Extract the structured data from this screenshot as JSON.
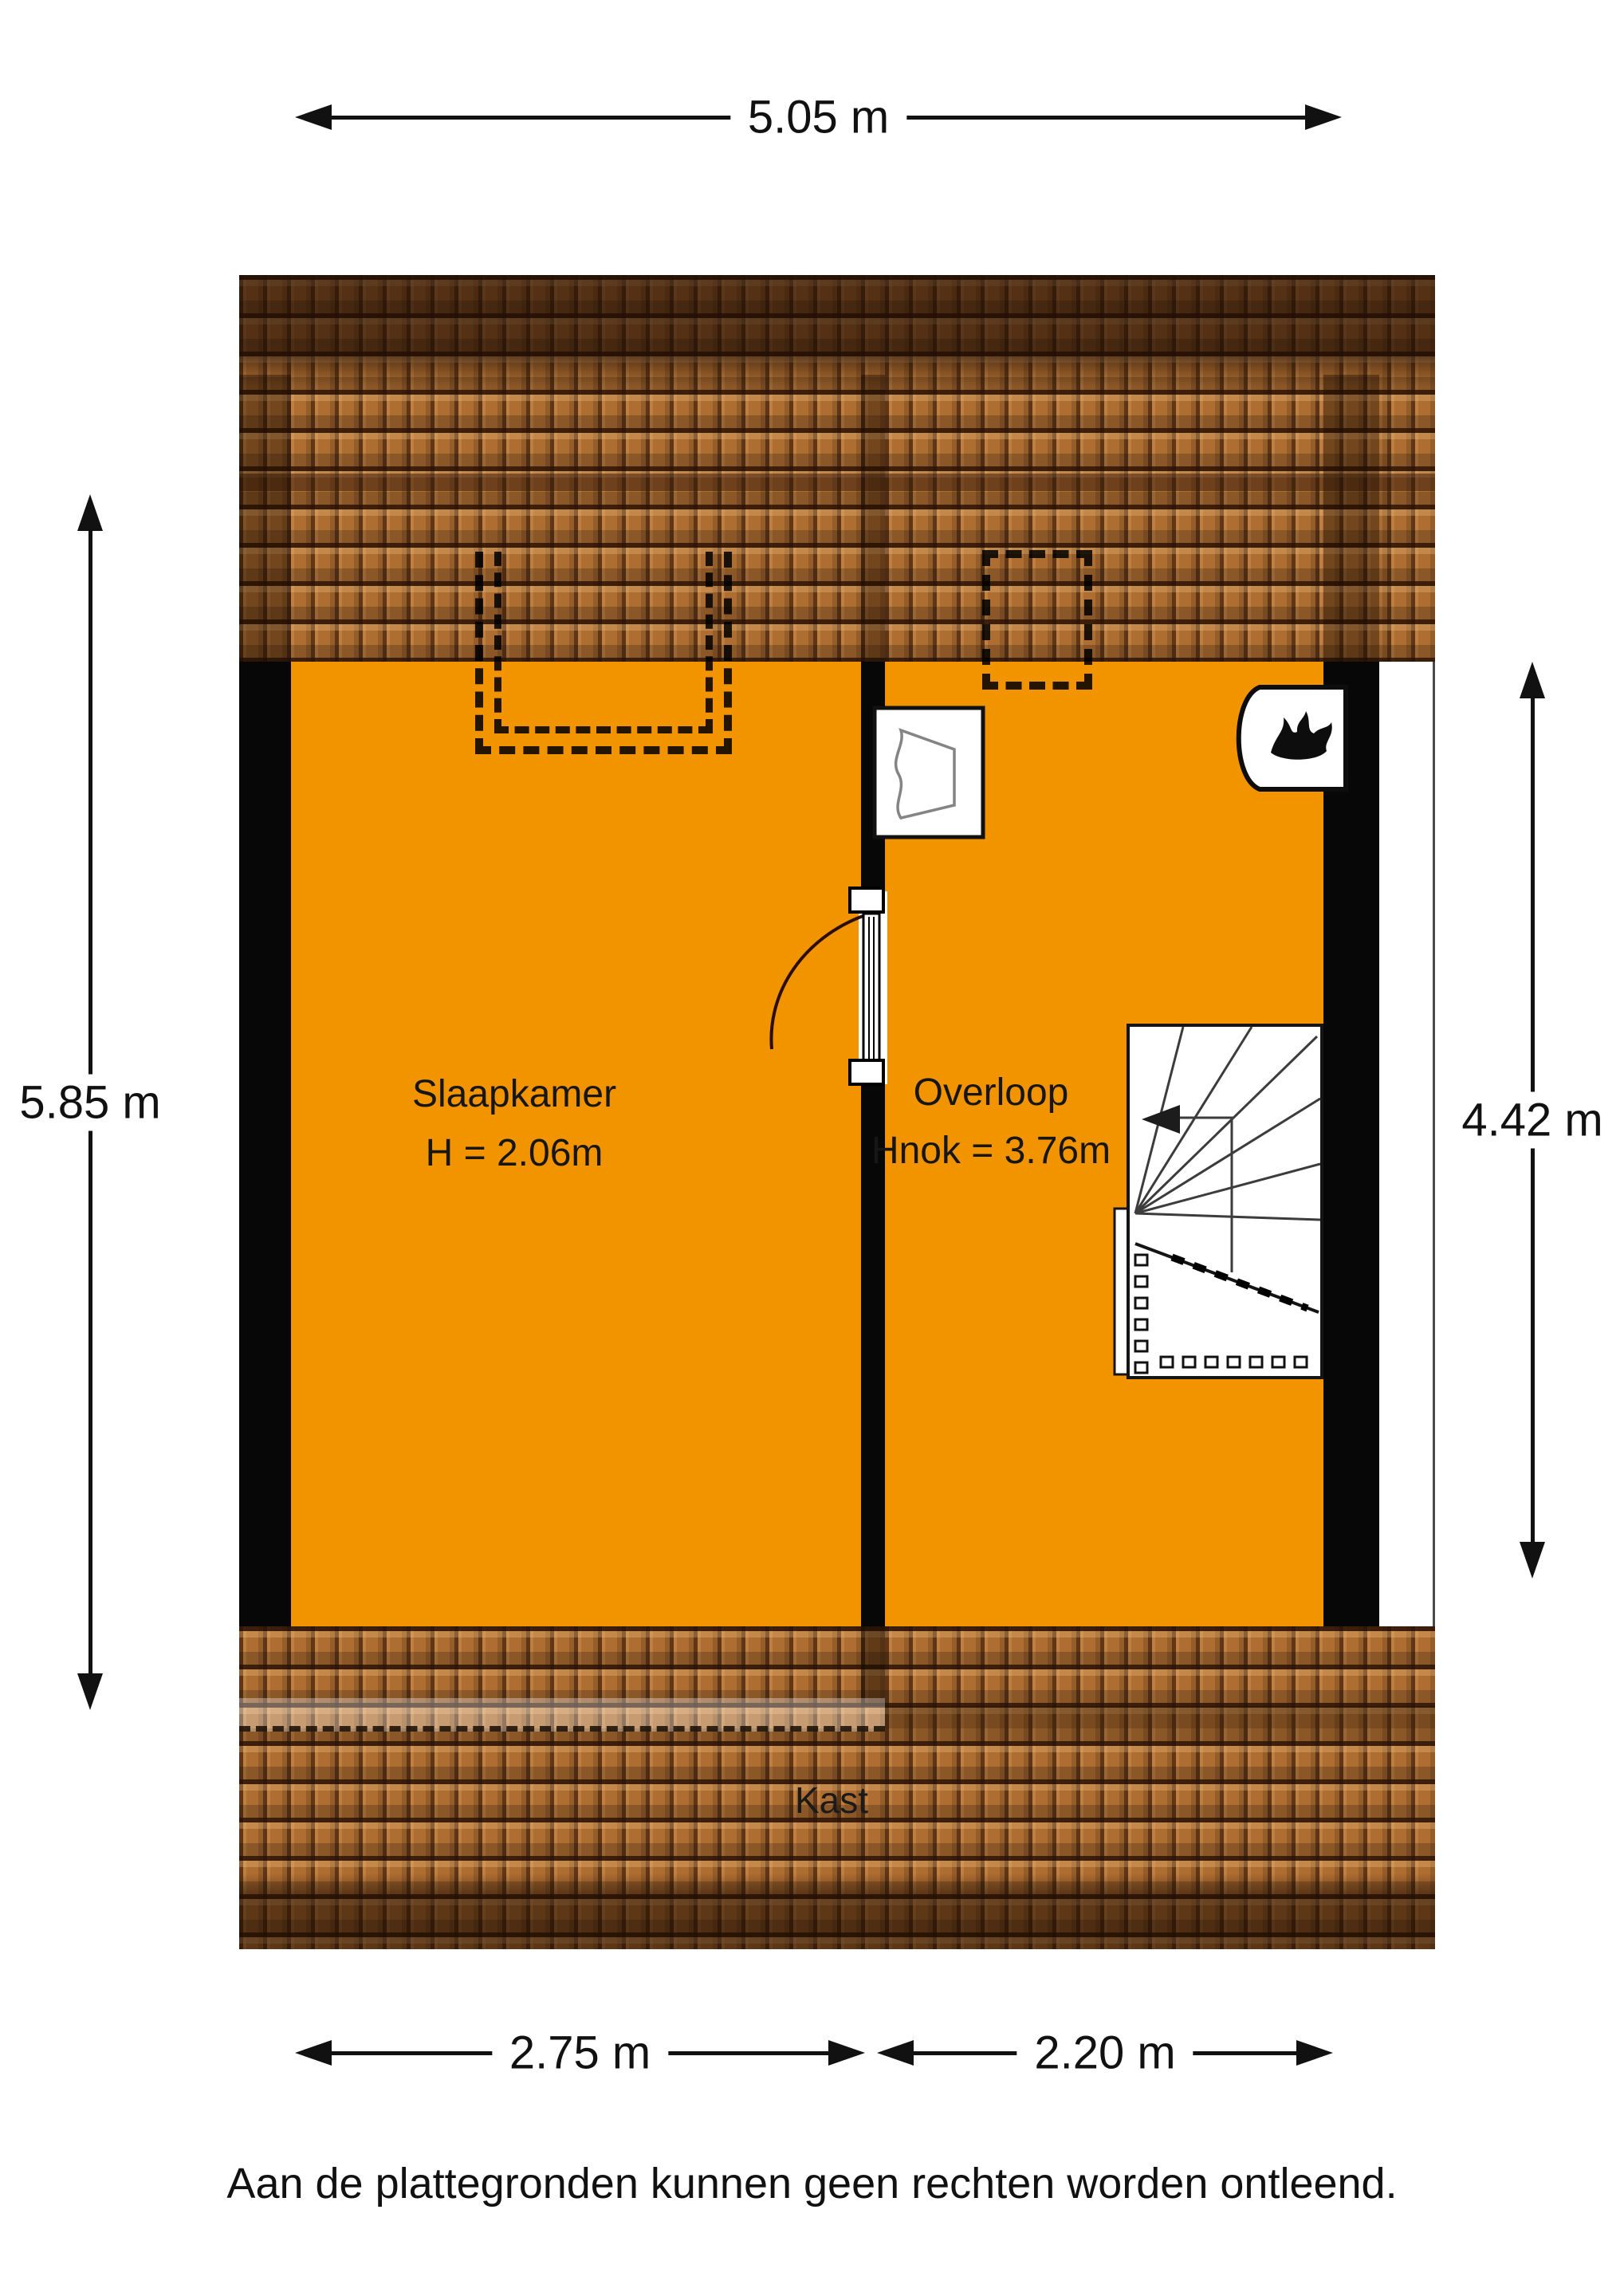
{
  "plan": {
    "dimensions": {
      "width_total": "5.05 m",
      "height_left": "5.85 m",
      "height_right": "4.42 m",
      "width_bottom_left": "2.75 m",
      "width_bottom_right": "2.20 m"
    },
    "rooms": {
      "slaapkamer": {
        "name": "Slaapkamer",
        "height": "H = 2.06m"
      },
      "overloop": {
        "name": "Overloop",
        "ridge_height": "Hnok = 3.76m"
      },
      "kast": {
        "name": "Kast"
      }
    },
    "icons": {
      "boiler": "flame-icon",
      "sink": "sink-icon",
      "stairs": "staircase-icon",
      "door": "door-swing-icon",
      "dormer_slaapkamer": "dormer-window-icon",
      "dormer_overloop": "dormer-window-icon"
    },
    "colors": {
      "floor": "#F29300",
      "roof_tile": "#AE6D31",
      "roof_dark": "#5F3A1E",
      "wall": "#070707"
    }
  },
  "footer": {
    "disclaimer": "Aan de plattegronden kunnen geen rechten worden ontleend."
  }
}
